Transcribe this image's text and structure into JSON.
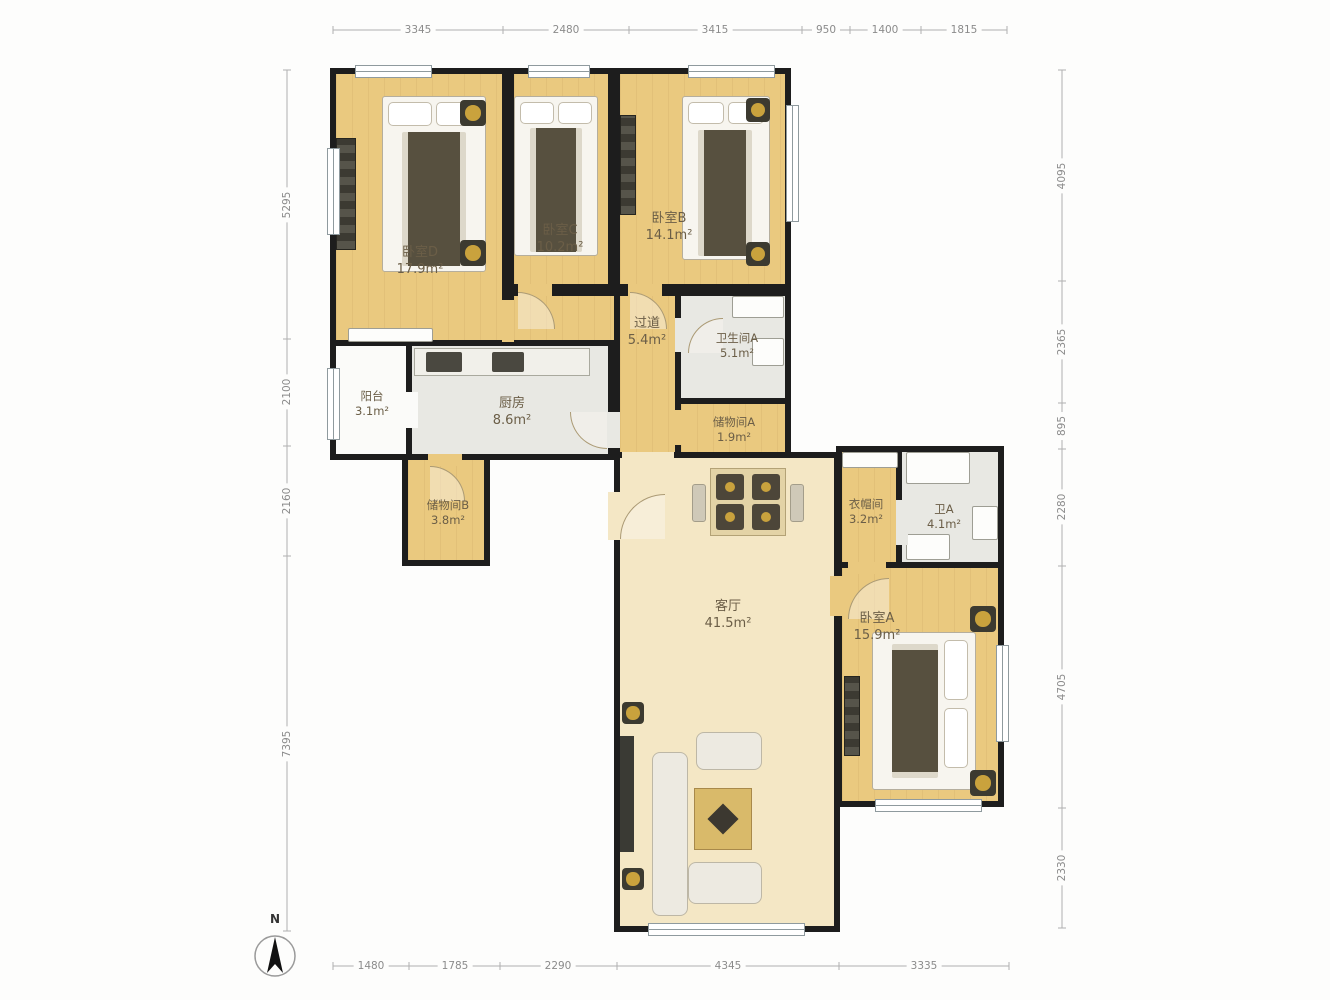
{
  "rooms": [
    {
      "id": "bedroom-d",
      "name": "卧室D",
      "area": "17.9m²"
    },
    {
      "id": "bedroom-c",
      "name": "卧室C",
      "area": "10.2m²"
    },
    {
      "id": "bedroom-b",
      "name": "卧室B",
      "area": "14.1m²"
    },
    {
      "id": "hallway",
      "name": "过道",
      "area": "5.4m²"
    },
    {
      "id": "bathroom-a",
      "name": "卫生间A",
      "area": "5.1m²"
    },
    {
      "id": "storage-a",
      "name": "储物间A",
      "area": "1.9m²"
    },
    {
      "id": "balcony",
      "name": "阳台",
      "area": "3.1m²"
    },
    {
      "id": "kitchen",
      "name": "厨房",
      "area": "8.6m²"
    },
    {
      "id": "storage-b",
      "name": "储物间B",
      "area": "3.8m²"
    },
    {
      "id": "living-room",
      "name": "客厅",
      "area": "41.5m²"
    },
    {
      "id": "cloakroom",
      "name": "衣帽间",
      "area": "3.2m²"
    },
    {
      "id": "bath-a",
      "name": "卫A",
      "area": "4.1m²"
    },
    {
      "id": "bedroom-a",
      "name": "卧室A",
      "area": "15.9m²"
    }
  ],
  "dimensions": {
    "top": [
      "3345",
      "2480",
      "3415",
      "950",
      "1400",
      "1815"
    ],
    "bottom": [
      "1480",
      "1785",
      "2290",
      "4345",
      "3335"
    ],
    "left": [
      "5295",
      "2100",
      "2160",
      "7395"
    ],
    "right": [
      "4095",
      "2365",
      "895",
      "2280",
      "4705",
      "2330"
    ]
  },
  "compass": {
    "label": "N"
  },
  "colors": {
    "wall": "#1d1d1d",
    "wood_floor": "#eac97f",
    "living_floor": "#f4e7c5",
    "tile_floor": "#e8e8e3",
    "gold_accent": "#c9a23d",
    "dimension_text": "#8b8b8b"
  }
}
